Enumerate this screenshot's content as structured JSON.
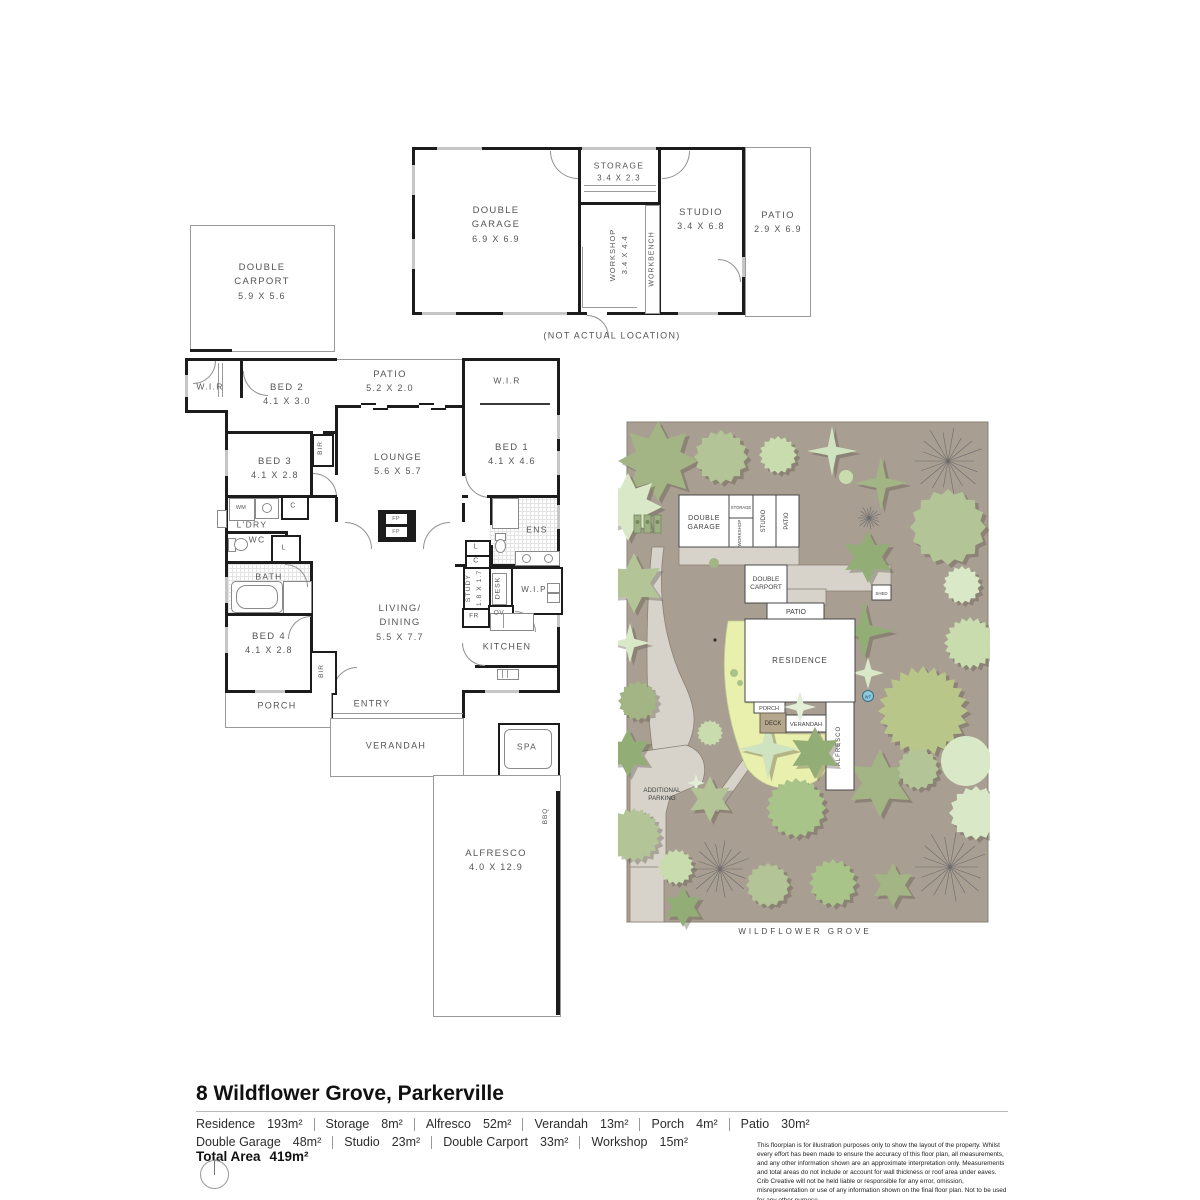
{
  "title": "8 Wildflower Grove, Parkerville",
  "outbuilding": {
    "garage_name": "DOUBLE GARAGE",
    "garage_dims": "6.9 X 6.9",
    "storage_name": "STORAGE",
    "storage_dims": "3.4 X 2.3",
    "workshop_name": "WORKSHOP",
    "workshop_dims": "3.4 X 4.4",
    "workbench": "WORKBENCH",
    "studio_name": "STUDIO",
    "studio_dims": "3.4 X 6.8",
    "patio_name": "PATIO",
    "patio_dims": "2.9 X 6.9",
    "caption": "(NOT ACTUAL LOCATION)"
  },
  "carport": {
    "name": "DOUBLE CARPORT",
    "dims": "5.9 X 5.6"
  },
  "house": {
    "wir_left": "W.I.R",
    "bed2_name": "BED 2",
    "bed2_dims": "4.1 X 3.0",
    "patio_name": "PATIO",
    "patio_dims": "5.2 X 2.0",
    "wir_right": "W.I.R",
    "bed1_name": "BED 1",
    "bed1_dims": "4.1 X 4.6",
    "bed3_name": "BED 3",
    "bed3_dims": "4.1 X 2.8",
    "bir": "BIR",
    "lounge_name": "LOUNGE",
    "lounge_dims": "5.6 X 5.7",
    "wm": "WM",
    "c1": "C",
    "ldry": "L'DRY",
    "wc": "WC",
    "l1": "L",
    "bath": "BATH",
    "fp": "FP",
    "ens": "ENS",
    "l2": "L",
    "c2": "C",
    "study_name": "STUDY",
    "study_dims": "1.8 X 1.7",
    "desk": "DESK",
    "wip": "W.I.P",
    "fr": "FR",
    "ov": "OV",
    "kitchen": "KITCHEN",
    "living_line1": "LIVING/",
    "living_line2": "DINING",
    "living_dims": "5.5 X 7.7",
    "bed4_name": "BED 4",
    "bed4_dims": "4.1 X 2.8",
    "bir2": "BIR",
    "porch": "PORCH",
    "entry": "ENTRY",
    "verandah": "VERANDAH",
    "spa": "SPA",
    "bbq": "BBQ",
    "alfresco_name": "ALFRESCO",
    "alfresco_dims": "4.0 X 12.9"
  },
  "site": {
    "garage1": "DOUBLE",
    "garage2": "GARAGE",
    "storage": "STORAGE",
    "workshop": "WORKSHOP",
    "studio": "STUDIO",
    "patio_top": "PATIO",
    "carport1": "DOUBLE",
    "carport2": "CARPORT",
    "patio": "PATIO",
    "shed": "SHED",
    "residence": "RESIDENCE",
    "porch": "PORCH",
    "deck": "DECK",
    "verandah": "VERANDAH",
    "alfresco": "ALFRESCO",
    "wt": "WT",
    "parking1": "ADDITIONAL",
    "parking2": "PARKING",
    "street": "WILDFLOWER GROVE"
  },
  "footer": {
    "areas_row1": [
      {
        "label": "Residence",
        "value": "193m²"
      },
      {
        "label": "Storage",
        "value": "8m²"
      },
      {
        "label": "Alfresco",
        "value": "52m²"
      },
      {
        "label": "Verandah",
        "value": "13m²"
      },
      {
        "label": "Porch",
        "value": "4m²"
      },
      {
        "label": "Patio",
        "value": "30m²"
      }
    ],
    "areas_row2": [
      {
        "label": "Double Garage",
        "value": "48m²"
      },
      {
        "label": "Studio",
        "value": "23m²"
      },
      {
        "label": "Double Carport",
        "value": "33m²"
      },
      {
        "label": "Workshop",
        "value": "15m²"
      }
    ],
    "total_label": "Total Area",
    "total_value": "419m²",
    "disclaimer": "This floorplan is for illustration purposes only to show the layout of the property. Whilst every effort has been made to ensure the accuracy of this floor plan, all measurements, and any other information shown are an approximate interpretation only. Measurements and total areas do not include or account for wall thickness or roof area under eaves. Crib Creative will not be held liable or responsible for any error, omission, misrepresentation or use of any information shown on the final floor plan. Not to be used for any other purpose.",
    "website": "www.cribcreative.com.au"
  },
  "colors": {
    "wall": "#1c1c1c",
    "thin": "#9a9a9a",
    "label": "#555555",
    "ground": "#a89e92",
    "driveway": "#d7d3ca",
    "lawn": "#e9efad",
    "accent_wt": "#8cc9df"
  }
}
